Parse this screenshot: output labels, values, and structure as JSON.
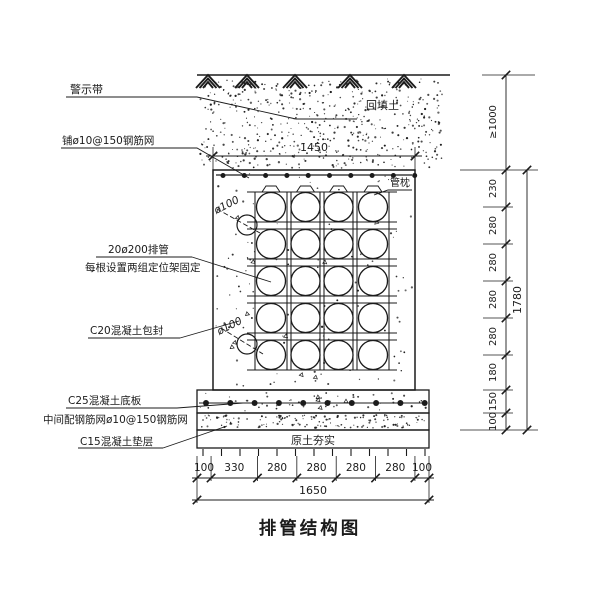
{
  "drawing": {
    "title": "排管结构图",
    "labels": {
      "warning_tape": "警示带",
      "top_mesh": "铺ø10@150钢筋网",
      "pipes_line1": "20ø200排管",
      "pipes_line2": "每根设置两组定位架固定",
      "encasement": "C20混凝土包封",
      "base_slab": "C25混凝土底板",
      "slab_mesh": "中间配钢筋网ø10@150钢筋网",
      "cushion": "C15混凝土垫层",
      "backfill": "回填土",
      "pipe_pillow": "管枕",
      "compacted_soil": "原土夯实",
      "pipe_diameter_upper": "ø100",
      "pipe_diameter_lower": "ø100"
    },
    "dimensions": {
      "top_width": "1450",
      "bottom_segments": [
        100,
        330,
        280,
        280,
        280,
        280,
        100
      ],
      "bottom_total": "1650",
      "cover_depth": "≥1000",
      "right_segments": [
        230,
        280,
        280,
        280,
        280,
        180,
        150,
        100
      ],
      "right_total": "1780"
    },
    "pipe_grid": {
      "columns": 4,
      "rows": 5
    },
    "colors": {
      "ink": "#1b1b1b",
      "paper": "#ffffff"
    }
  }
}
